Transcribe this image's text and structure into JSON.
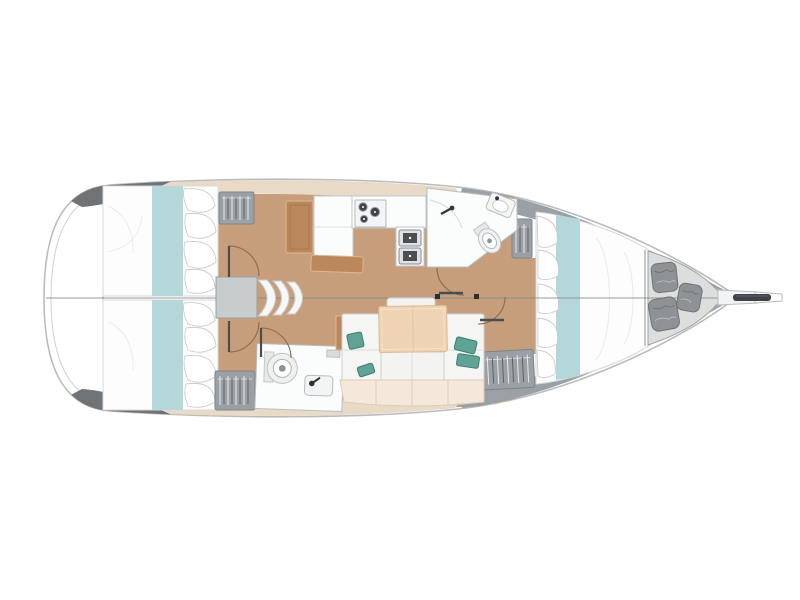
{
  "canvas": {
    "background": "#ffffff"
  },
  "palette": {
    "background": "#ffffff",
    "hull_outline": "#b9bcbe",
    "hull_inner_line": "#cdd0d2",
    "hull_dark_gray": "#6f7376",
    "deck_beige": "#e8dac7",
    "bow_wall_gray": "#9aa0a4",
    "anchor_locker_gray": "#dcdddd",
    "floor_wood": "#c79e7b",
    "desk_wood": "#bb875d",
    "table_wood": "#eed4b4",
    "bench_cream": "#f3e8d9",
    "mattress_white": "#fdfdfd",
    "bed_teal": "#b4d8da",
    "pillow_teal": "#5fa396",
    "locker_gray": "#9aa0a5",
    "bag_gray": "#8e9295",
    "room_white": "#fbfcfc",
    "appliance_dark": "#3f4347",
    "step_gray": "#c9cccd",
    "door_arc_brown": "#8a6a4e",
    "door_leaf_dark": "#4a4d50"
  },
  "counts": {
    "berth_cabins": 3,
    "heads": 2,
    "stove_burners": 3,
    "sink_basins": 2,
    "companionway_steps": 3,
    "hanging_lockers": 4,
    "bow_locker_bags": 3,
    "teal_cushions": 4
  },
  "plan": {
    "orientation": "bow-right",
    "cabins": [
      "aft-cabin-port",
      "aft-cabin-starboard",
      "forward-cabin"
    ],
    "heads": [
      "aft-head",
      "forward-head"
    ],
    "galley_features": [
      "stove-3-burner",
      "double-sink",
      "counter",
      "fridge-unit"
    ],
    "saloon_features": [
      "u-shaped-sofa",
      "dining-table",
      "teal-cushions",
      "wood-end-unit"
    ],
    "other_features": [
      "companionway-steps",
      "nav-desk",
      "galley-bench",
      "hanging-lockers",
      "anchor-locker-with-bags",
      "bowsprit-anchor-roller",
      "centerline"
    ]
  }
}
